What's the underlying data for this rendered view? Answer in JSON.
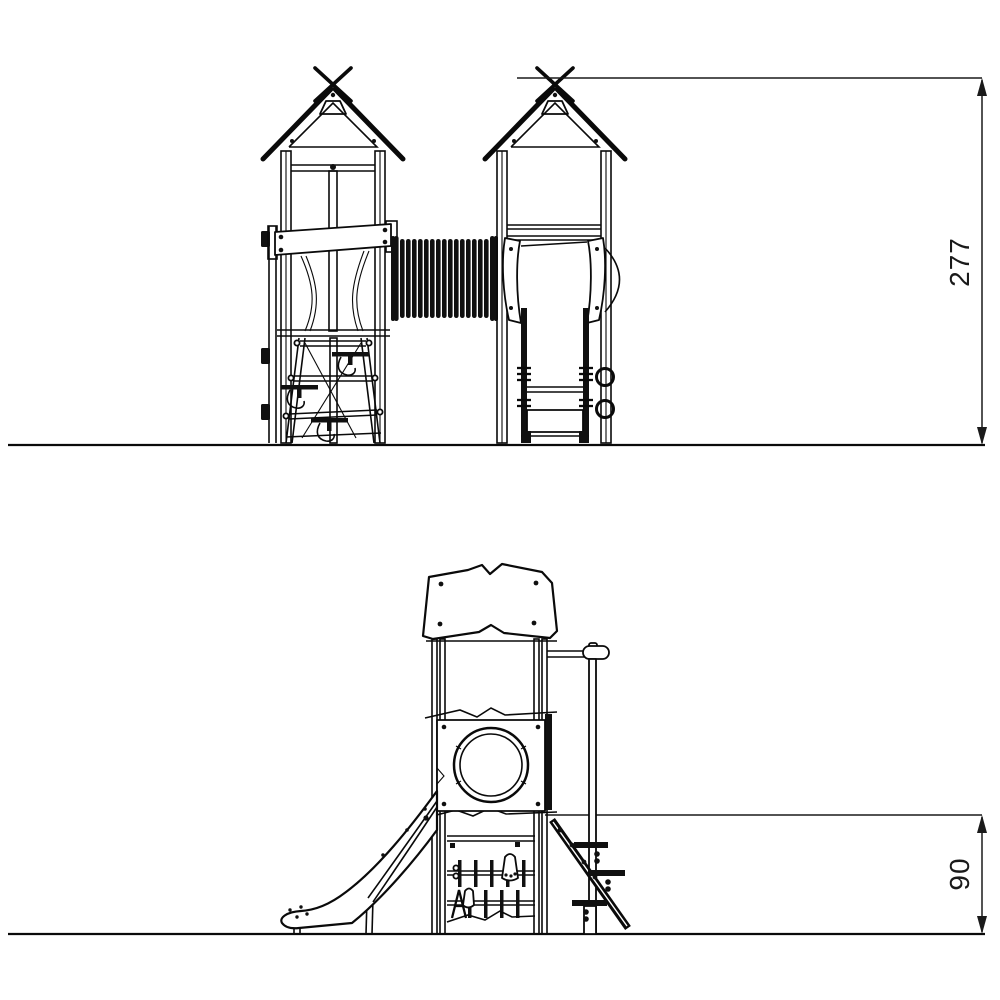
{
  "front_view": {
    "height_dimension": "277"
  },
  "side_view": {
    "height_dimension": "90"
  },
  "colors": {
    "line": "#0a0a0a",
    "background": "#ffffff",
    "text": "#1a1a1a"
  }
}
